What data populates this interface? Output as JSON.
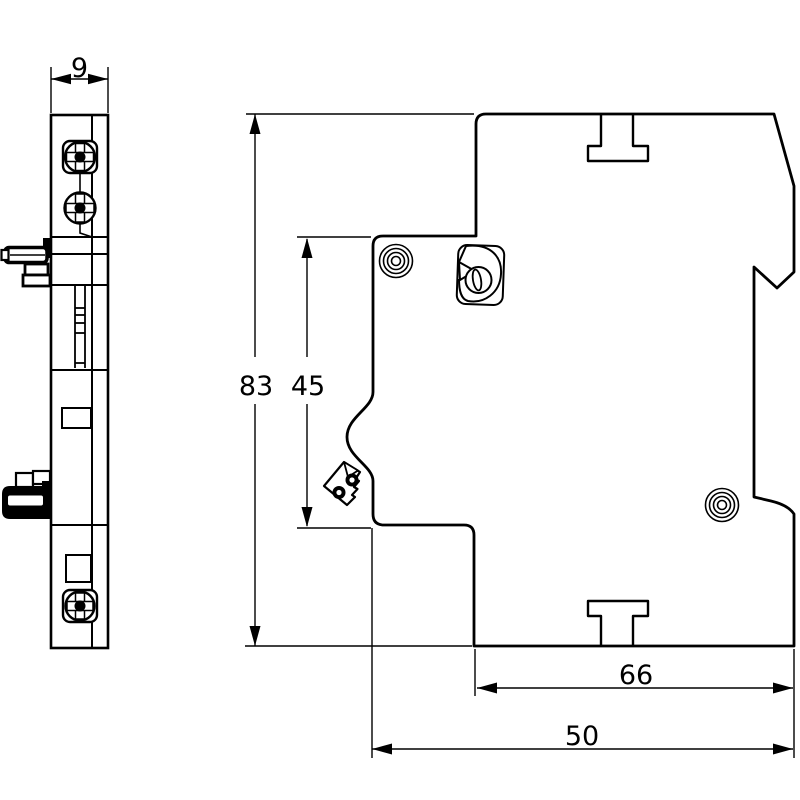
{
  "drawing": {
    "dimensions": {
      "width": "9",
      "overall_height": "83",
      "upper_section_height": "45",
      "depth_upper": "66",
      "depth_lower": "50"
    },
    "colors": {
      "line": "#000000",
      "background": "#ffffff"
    }
  }
}
